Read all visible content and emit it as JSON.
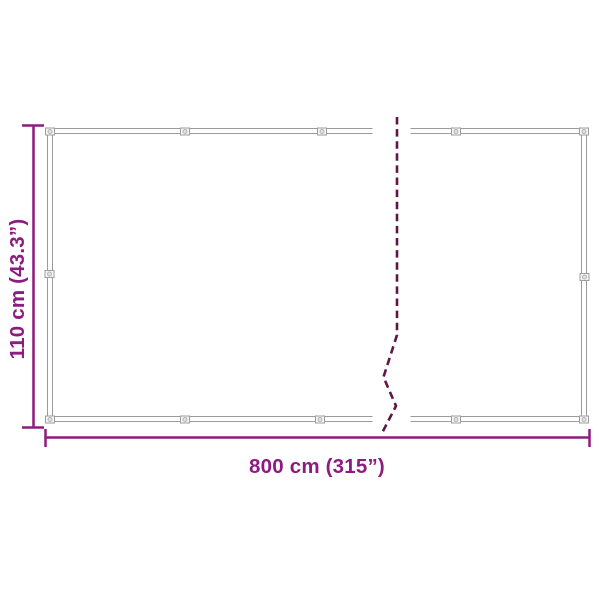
{
  "diagram": {
    "title": "Product dimension diagram",
    "height_label": "110 cm (43.3”)",
    "width_label": "800 cm (315”)",
    "colors": {
      "dimension_accent": "#8E1B80",
      "break_line": "#5E1745",
      "frame_outline": "#9B9B9B"
    }
  }
}
